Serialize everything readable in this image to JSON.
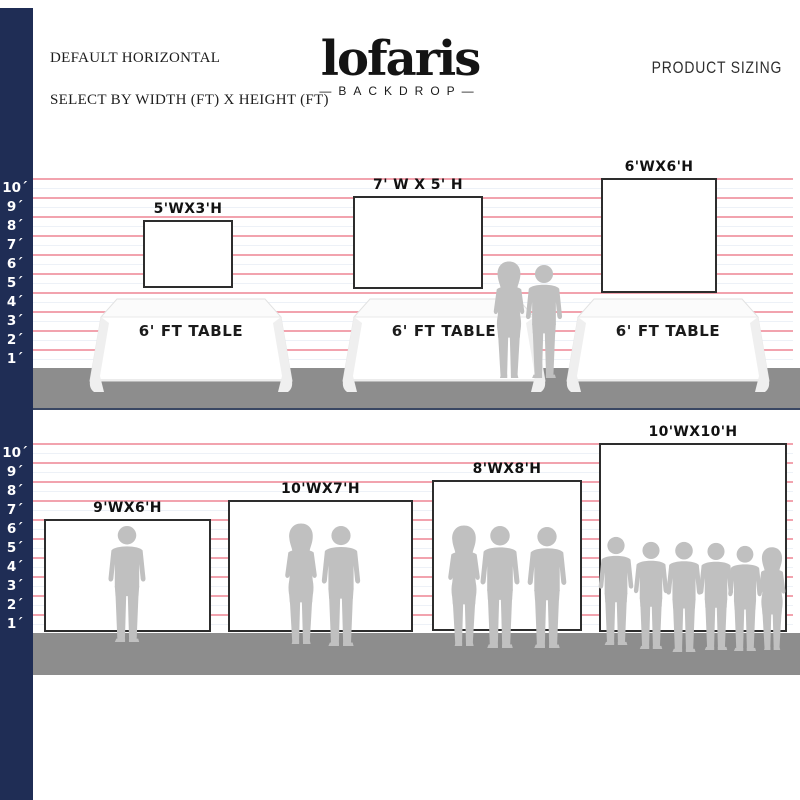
{
  "header": {
    "left_line1": "DEFAULT HORIZONTAL",
    "left_line2": "SELECT BY WIDTH (FT) X HEIGHT (FT)",
    "logo": "lofaris",
    "logo_sub": "—BACKDROP—",
    "right_title": "PRODUCT SIZING"
  },
  "colors": {
    "navy_bar": "#1f2d55",
    "pink_line": "#f2a3ae",
    "floor_gray": "#8d8d8d",
    "silhouette_gray": "#c0c0c0",
    "backdrop_border": "#2d2d2d"
  },
  "ruler": {
    "unit": "ft",
    "labels": [
      "10´",
      "9´",
      "8´",
      "7´",
      "6´",
      "5´",
      "4´",
      "3´",
      "2´",
      "1´"
    ]
  },
  "sections": [
    {
      "name": "with-tables",
      "table_label": "6' FT TABLE",
      "table_count": 3,
      "backdrops": [
        {
          "label": "5'WX3'H",
          "width_ft": 5,
          "height_ft": 3
        },
        {
          "label": "7' W X 5' H",
          "width_ft": 7,
          "height_ft": 5
        },
        {
          "label": "6'WX6'H",
          "width_ft": 6,
          "height_ft": 6
        }
      ],
      "people_count": 2
    },
    {
      "name": "on-floor",
      "backdrops": [
        {
          "label": "9'WX6'H",
          "width_ft": 9,
          "height_ft": 6,
          "people_count": 1
        },
        {
          "label": "10'WX7'H",
          "width_ft": 10,
          "height_ft": 7,
          "people_count": 2
        },
        {
          "label": "8'WX8'H",
          "width_ft": 8,
          "height_ft": 8,
          "people_count": 3
        },
        {
          "label": "10'WX10'H",
          "width_ft": 10,
          "height_ft": 10,
          "people_count": 6
        }
      ]
    }
  ]
}
